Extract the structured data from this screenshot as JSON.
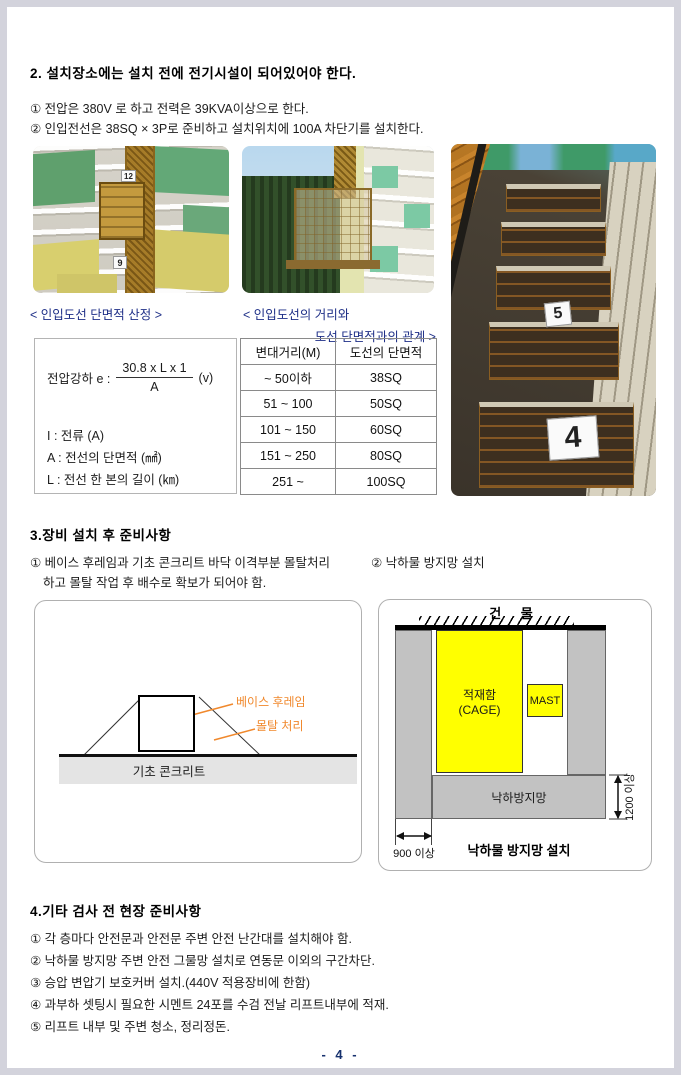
{
  "colors": {
    "accent_navy": "#1e2f87",
    "label_orange": "#f0882c",
    "cage_yellow": "#ffff00",
    "gray_fill": "#c2c2c2",
    "page_border": "#d3d3dc"
  },
  "section2": {
    "heading": "2. 설치장소에는 설치 전에 전기시설이 되어있어야 한다.",
    "items": [
      "① 전압은 380V 로 하고 전력은 39KVA이상으로 한다.",
      "② 인입전선은 38SQ × 3P로 준비하고 설치위치에 100A 차단기를 설치한다."
    ]
  },
  "photos": {
    "photo1": {
      "signs": [
        "12",
        "9"
      ]
    },
    "photo3": {
      "floor_signs": [
        "5",
        "4"
      ]
    }
  },
  "captions": {
    "formula": "< 인입도선 단면적 산정 >",
    "table_line1": "< 인입도선의 거리와",
    "table_line2": "도선 단면적과의 관계 >"
  },
  "formula_box": {
    "intro": "전압강하 e :",
    "numerator": "30.8 x L x 1",
    "denominator": "A",
    "unit": "(v)",
    "legend": [
      "I : 전류 (A)",
      "A : 전선의 단면적 (㎟)",
      "L : 전선 한 본의 길이 (㎞)"
    ]
  },
  "wire_table": {
    "headers": [
      "변대거리(M)",
      "도선의 단면적"
    ],
    "rows": [
      [
        "~ 50이하",
        "38SQ"
      ],
      [
        "51 ~ 100",
        "50SQ"
      ],
      [
        "101 ~ 150",
        "60SQ"
      ],
      [
        "151 ~ 250",
        "80SQ"
      ],
      [
        "251 ~",
        "100SQ"
      ]
    ]
  },
  "section3": {
    "heading": "3.장비 설치 후 준비사항",
    "item1_line1": "① 베이스 후레임과 기초 콘크리트 바닥 이격부분 몰탈처리",
    "item1_line2": "하고 몰탈 작업 후 배수로 확보가 되어야 함.",
    "item2": "② 낙하물 방지망 설치"
  },
  "base_diagram": {
    "label_frame": "베이스 후레임",
    "label_mortar": "몰탈 처리",
    "label_concrete": "기초 콘크리트"
  },
  "net_diagram": {
    "building": "건 물",
    "cage_line1": "적재함",
    "cage_line2": "(CAGE)",
    "mast": "MAST",
    "net": "낙하방지망",
    "dim_height": "1200 이상",
    "dim_width": "900 이상",
    "caption": "낙하물 방지망 설치"
  },
  "section4": {
    "heading": "4.기타 검사 전 현장 준비사항",
    "items": [
      "① 각 층마다 안전문과 안전문 주변 안전 난간대를 설치해야 함.",
      "② 낙하물 방지망 주변 안전 그물망 설치로 연동문 이외의 구간차단.",
      "③ 승압 변압기 보호커버 설치.(440V 적용장비에 한함)",
      "④ 과부하 셋팅시 필요한 시멘트 24포를 수검 전날 리프트내부에 적재.",
      "⑤ 리프트 내부 및 주변 청소, 정리정돈."
    ]
  },
  "footer": {
    "page_label": "- 4 -"
  }
}
